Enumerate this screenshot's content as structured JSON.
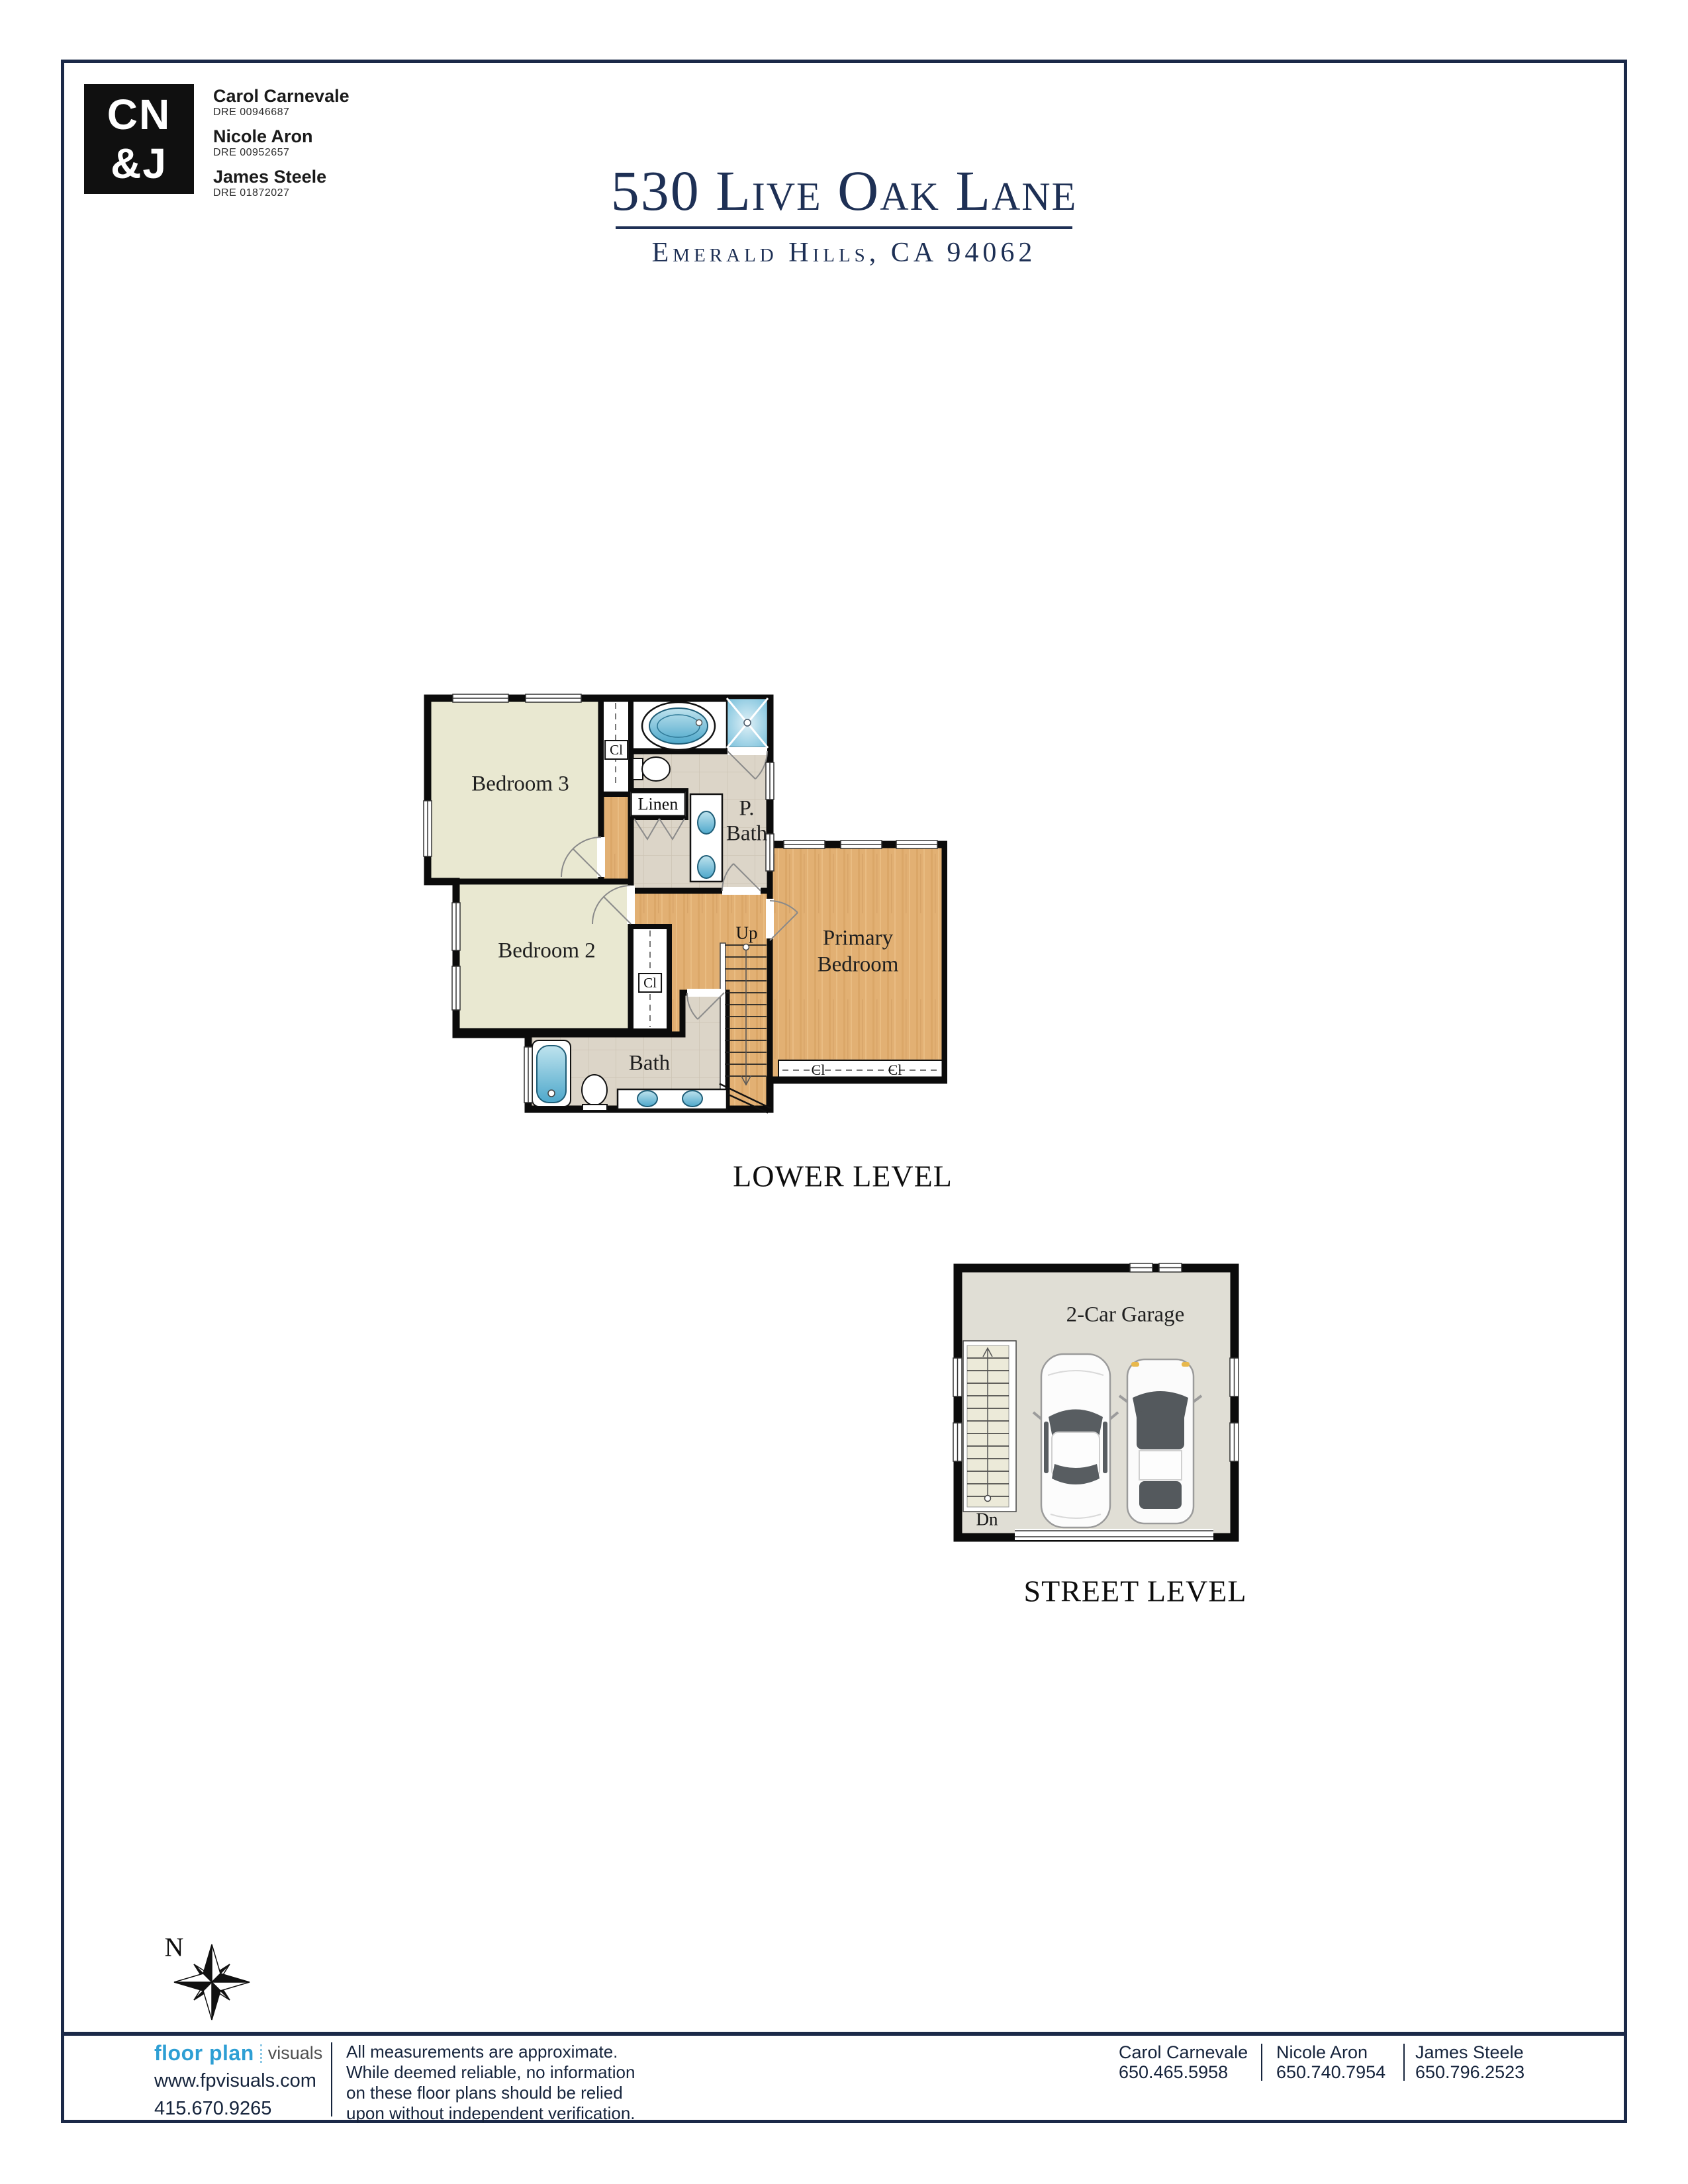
{
  "header": {
    "logo_square": {
      "line1": "CN",
      "line2": "&J"
    },
    "agents": [
      {
        "name": "Carol Carnevale",
        "dre": "DRE 00946687"
      },
      {
        "name": "Nicole Aron",
        "dre": "DRE 00952657"
      },
      {
        "name": "James Steele",
        "dre": "DRE 01872027"
      }
    ],
    "title": "530 Live Oak Lane",
    "subtitle": "Emerald Hills, CA 94062",
    "accent_color": "#1e3055"
  },
  "floor_plans": {
    "lower_level": {
      "title": "LOWER LEVEL",
      "rooms": {
        "bedroom3": "Bedroom 3",
        "bedroom2": "Bedroom 2",
        "bath": "Bath",
        "primary_bath_line1": "P.",
        "primary_bath_line2": "Bath",
        "primary_bedroom_line1": "Primary",
        "primary_bedroom_line2": "Bedroom",
        "linen": "Linen",
        "closet_abbr": "Cl",
        "stairs_up": "Up"
      }
    },
    "street_level": {
      "title": "STREET LEVEL",
      "garage": "2-Car Garage",
      "stairs_down": "Dn"
    }
  },
  "compass": {
    "north": "N"
  },
  "footer": {
    "brand": {
      "name_bold": "floor plan",
      "name_light": "visuals",
      "website": "www.fpvisuals.com",
      "phone": "415.670.9265",
      "brand_color": "#2e9fd4"
    },
    "disclaimer": [
      "All measurements are approximate.",
      "While deemed reliable, no information",
      "on these floor plans should be relied",
      "upon without independent verification."
    ],
    "agents": [
      {
        "name": "Carol Carnevale",
        "phone": "650.465.5958"
      },
      {
        "name": "Nicole Aron",
        "phone": "650.740.7954"
      },
      {
        "name": "James Steele",
        "phone": "650.796.2523"
      }
    ]
  },
  "palette": {
    "navy": "#1e3055",
    "frame": "#1b2948",
    "bedroom_fill": "#e9e8d1",
    "wood_fill": "#e2b073",
    "tile_fill": "#dcd5c8",
    "garage_fill": "#e0ded5",
    "fixture_blue": "#5fb3d3",
    "wall": "#0b0b0b"
  }
}
